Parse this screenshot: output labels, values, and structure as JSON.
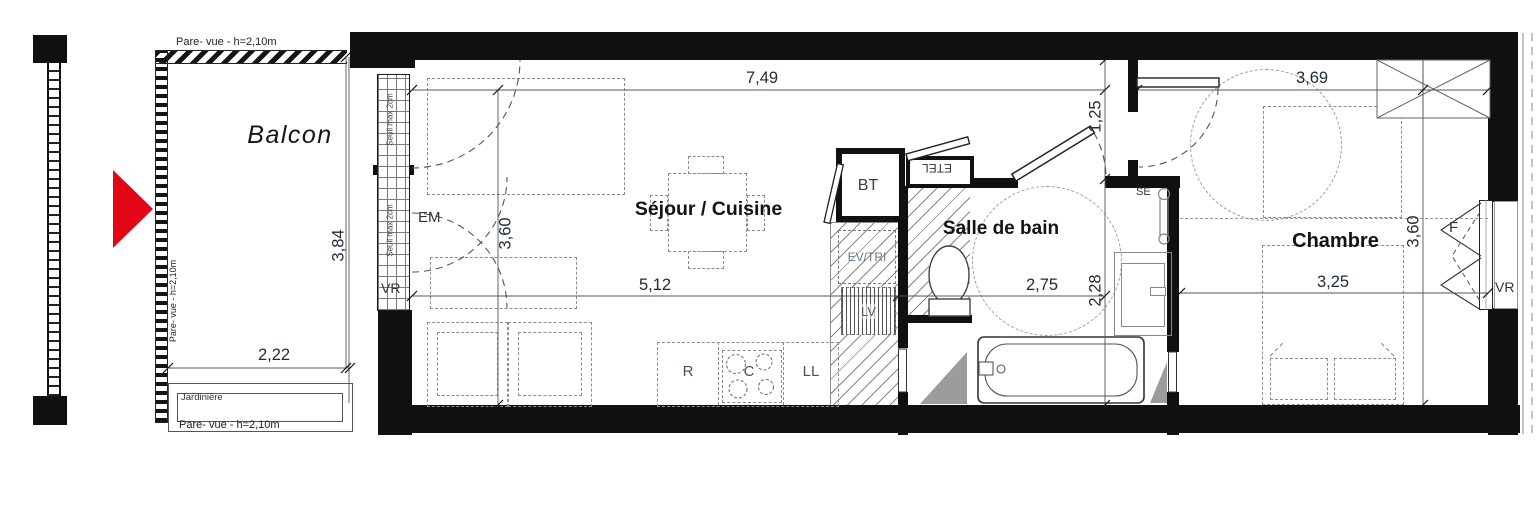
{
  "rooms": {
    "balcon": "Balcon",
    "sejour": "Séjour / Cuisine",
    "salle_de_bain": "Salle de bain",
    "chambre": "Chambre"
  },
  "dimensions": {
    "sejour_width": "7,49",
    "chambre_width": "3,69",
    "entry_passage": "1,25",
    "sejour_depth": "3,60",
    "kitchen_run": "5,12",
    "bath_width": "2,75",
    "bath_depth": "2,28",
    "chambre_bed_wall": "3,25",
    "chambre_depth": "3,60",
    "balcon_width": "2,22",
    "balcon_depth": "3,84"
  },
  "annotations": {
    "pare_vue_top": "Pare- vue - h=2,10m",
    "pare_vue_left": "Pare- vue - h=2,10m",
    "pare_vue_bottom": "Pare- vue - h=2,10m",
    "seuil_top": "Seuil max 2cm",
    "seuil_bottom": "Seuil max 2cm",
    "jardiniere": "Jardinière"
  },
  "equipment": {
    "em": "EM",
    "vr_balcony": "VR",
    "bt": "BT",
    "etel": "ETEL",
    "ev_tri": "EV/TRI",
    "lv": "LV",
    "fridge": "R",
    "cooktop": "C",
    "washer": "LL",
    "towel_dryer": "SE",
    "window": "F",
    "vr_bedroom": "VR"
  },
  "colors": {
    "wall": "#101010",
    "entrance_arrow": "#e30617",
    "label_accent": "#45525f"
  }
}
